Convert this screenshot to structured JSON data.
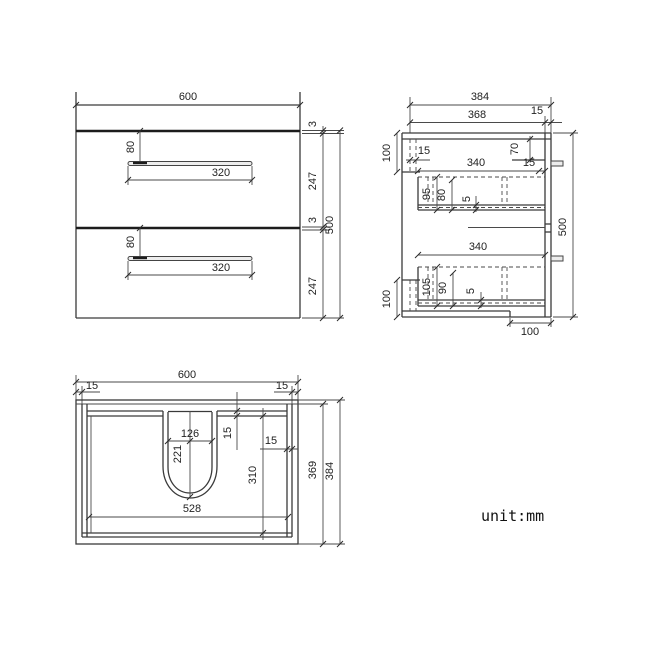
{
  "note": {
    "unit_label": "unit:mm"
  },
  "front_view": {
    "width": "600",
    "height": "500",
    "gap_1": "3",
    "drawer_height_1": "247",
    "gap_2": "3",
    "drawer_height_2": "247",
    "handle_offset_1": "80",
    "handle_width_1": "320",
    "handle_offset_2": "80",
    "handle_width_2": "320"
  },
  "side_view": {
    "depth": "384",
    "inner_depth": "368",
    "front_inset": "15",
    "bracket_height_top": "100",
    "bracket_thickness_top": "15",
    "rail_height": "70",
    "drawer_depth_1": "340",
    "drawer_front_gap_1": "15",
    "drawer_back_1": "95",
    "drawer_side_1": "80",
    "drawer_bottom_1": "5",
    "height": "500",
    "drawer_depth_2": "340",
    "drawer_back_2": "105",
    "drawer_side_2": "90",
    "drawer_bottom_2": "5",
    "bracket_height_bottom": "100",
    "notch_width": "100"
  },
  "top_view": {
    "width": "600",
    "edge_inset_left": "15",
    "edge_inset_right": "15",
    "cutout_width": "126",
    "cutout_depth": "221",
    "back_rail_thickness": "15",
    "wall_thickness_right": "15",
    "inner_depth": "310",
    "inner_width": "528",
    "body_depth": "369",
    "depth": "384"
  }
}
